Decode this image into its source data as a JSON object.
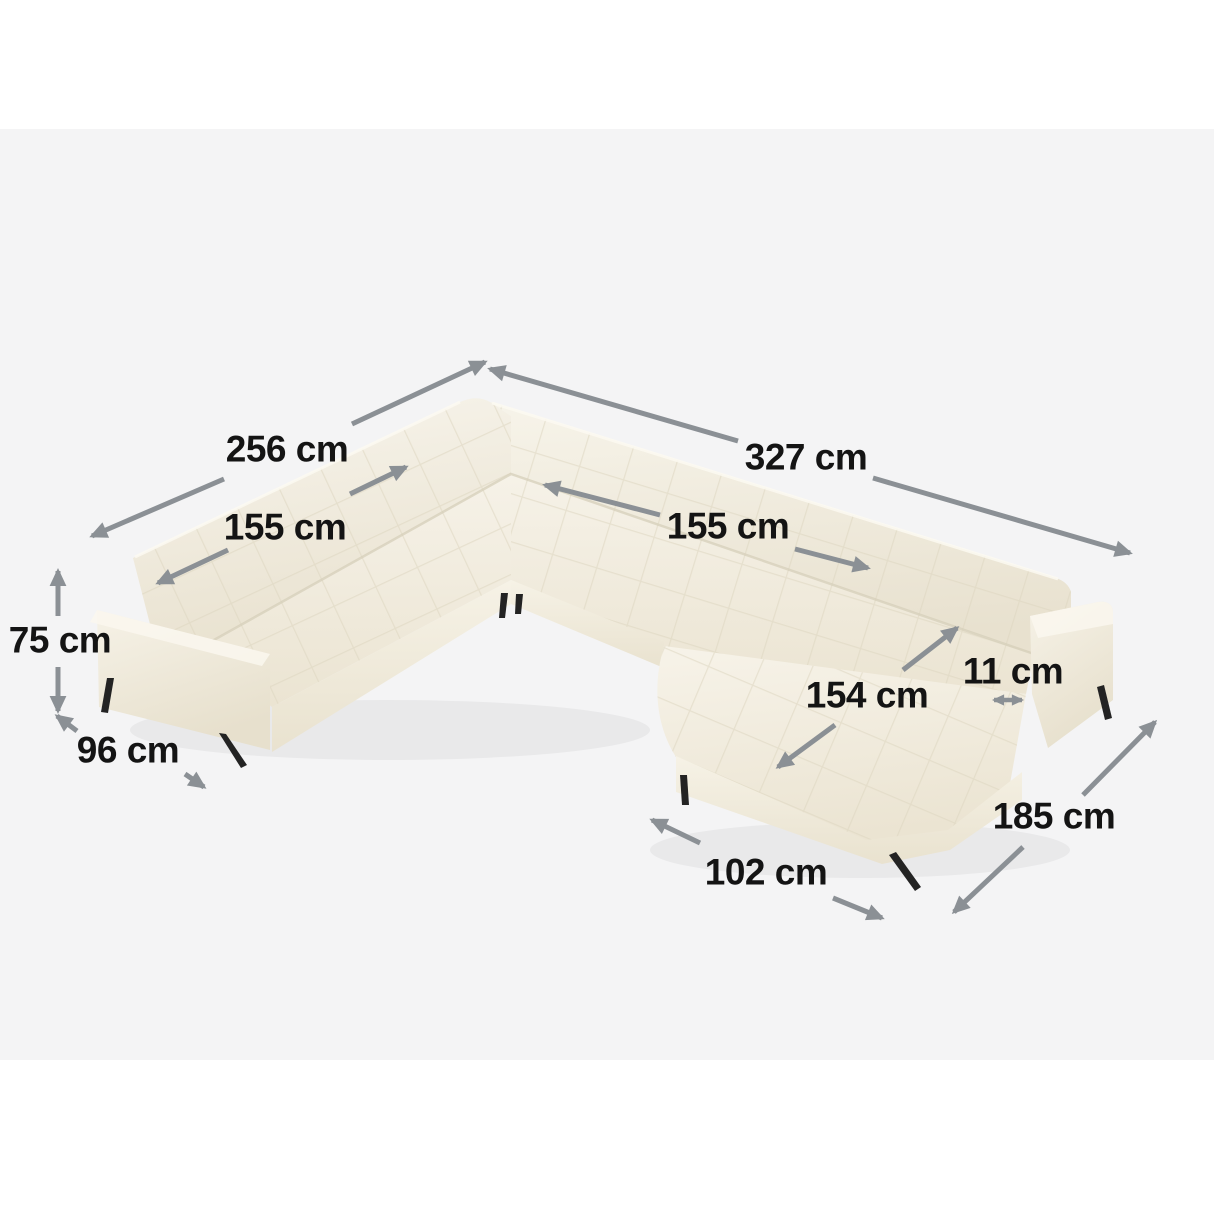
{
  "theme": {
    "page_bg": "#ffffff",
    "stage_bg": "#f4f4f5",
    "arrow_color": "#8b9095",
    "label_color": "#141414",
    "leg_color": "#232323",
    "fabric_color": "#f2ecdf"
  },
  "product": {
    "type": "u-shaped panoramic sectional sofa with chaise",
    "fabric": "cream tufted upholstery",
    "legs": "black metal"
  },
  "measurements": {
    "back_left_width": {
      "label": "256 cm"
    },
    "back_right_width": {
      "label": "327 cm"
    },
    "left_seat_width": {
      "label": "155 cm"
    },
    "right_seat_width": {
      "label": "155 cm"
    },
    "seat_height": {
      "label": "75 cm"
    },
    "depth": {
      "label": "96 cm"
    },
    "chaise_length": {
      "label": "154 cm"
    },
    "arm_gap": {
      "label": "11 cm"
    },
    "right_side_depth": {
      "label": "185 cm"
    },
    "chaise_width": {
      "label": "102 cm"
    }
  }
}
